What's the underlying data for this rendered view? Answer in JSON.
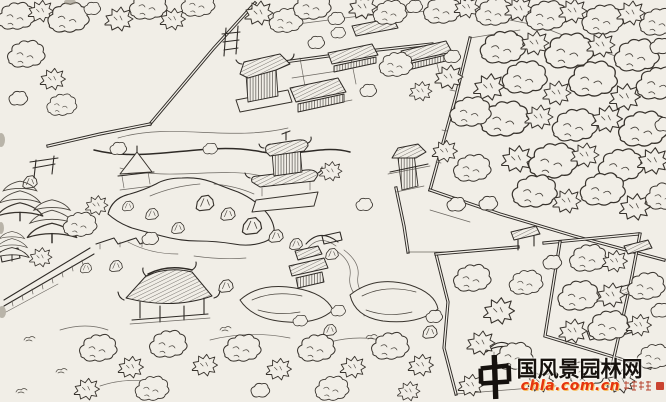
{
  "scene": {
    "description": "Hand-drawn aerial perspective sketch of a walled classical Chinese garden with pavilions, halls, a central pond, bridges, rockeries and many scribbled trees",
    "paper_color": "#f1eee7",
    "ink_color": "#2e2a26",
    "watermark_red": "#e5340e"
  },
  "watermark": {
    "logo_char": "中",
    "site_name": "国风景园林网",
    "full_site_name": "中国风景园林网",
    "url": "chla.com.cn"
  }
}
